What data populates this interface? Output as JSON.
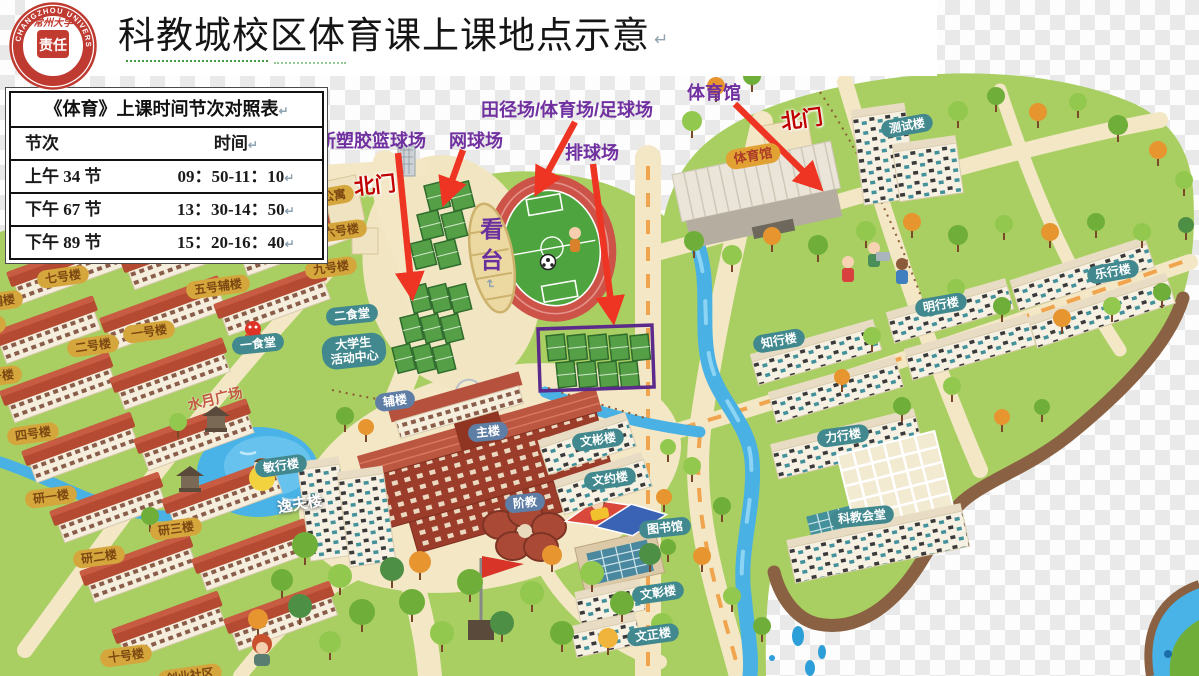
{
  "header": {
    "title": "科教城校区体育课上课地点示意",
    "return_mark": "↵",
    "logo": {
      "university_cn": "常州大学",
      "university_en": "CHANGZHOU UNIVERSITY",
      "year": "·1978·",
      "seal": "责任"
    }
  },
  "schedule_table": {
    "title": "《体育》上课时间节次对照表",
    "columns": [
      "节次",
      "时间"
    ],
    "rows": [
      {
        "period": "上午 34 节",
        "time": "09：50-11：10"
      },
      {
        "period": "下午 67 节",
        "time": "13：30-14：50"
      },
      {
        "period": "下午 89 节",
        "time": "15：20-16：40"
      }
    ]
  },
  "callouts": [
    {
      "name": "new-basketball-courts",
      "text": "新塑胶篮球场",
      "x": 318,
      "y": 127,
      "arrow": {
        "x1": 398,
        "y1": 153,
        "x2": 412,
        "y2": 294
      }
    },
    {
      "name": "tennis-courts",
      "text": "网球场",
      "x": 449,
      "y": 127,
      "arrow": {
        "x1": 463,
        "y1": 150,
        "x2": 445,
        "y2": 200
      }
    },
    {
      "name": "track-stadium-football-field",
      "text": "田径场/体育场/足球场",
      "x": 481,
      "y": 96,
      "arrow": {
        "x1": 575,
        "y1": 122,
        "x2": 538,
        "y2": 190
      }
    },
    {
      "name": "volleyball-courts",
      "text": "排球场",
      "x": 565,
      "y": 139,
      "arrow": {
        "x1": 593,
        "y1": 164,
        "x2": 613,
        "y2": 318
      }
    },
    {
      "name": "gymnasium",
      "text": "体育馆",
      "x": 687,
      "y": 79,
      "arrow": {
        "x1": 735,
        "y1": 104,
        "x2": 818,
        "y2": 186
      }
    }
  ],
  "highlight_box": {
    "x": 538,
    "y": 329,
    "w": 114,
    "h": 62,
    "color": "#5c2a8a"
  },
  "map_labels": [
    {
      "name": "north-gate-west",
      "text": "北门",
      "type": "gate",
      "x": 375,
      "y": 186,
      "r": -6
    },
    {
      "name": "north-gate-east",
      "text": "北门",
      "type": "gate",
      "x": 802,
      "y": 120,
      "r": -8
    },
    {
      "name": "apartment",
      "text": "公寓",
      "type": "olive",
      "x": 334,
      "y": 196,
      "r": -10
    },
    {
      "name": "dorm-7",
      "text": "七号楼",
      "type": "olive",
      "x": 63,
      "y": 277,
      "r": -8
    },
    {
      "name": "dorm-5-annex",
      "text": "五号辅楼",
      "type": "olive",
      "x": 218,
      "y": 287,
      "r": -8
    },
    {
      "name": "dorm-9",
      "text": "九号楼",
      "type": "olive",
      "x": 331,
      "y": 268,
      "r": -8
    },
    {
      "name": "dorm-6",
      "text": "六号楼",
      "type": "olive",
      "x": 341,
      "y": 231,
      "r": -8
    },
    {
      "name": "dorm-1",
      "text": "一号楼",
      "type": "olive",
      "x": 149,
      "y": 332,
      "r": -8
    },
    {
      "name": "dorm-2",
      "text": "二号楼",
      "type": "olive",
      "x": 93,
      "y": 346,
      "r": -8
    },
    {
      "name": "annex-partial",
      "text": "辅楼",
      "type": "olive",
      "x": 3,
      "y": 301,
      "r": -8
    },
    {
      "name": "dorm-8",
      "text": "八号楼",
      "type": "olive",
      "x": -20,
      "y": 327,
      "r": -8
    },
    {
      "name": "dorm-3",
      "text": "三号楼",
      "type": "olive",
      "x": -4,
      "y": 377,
      "r": -8
    },
    {
      "name": "dorm-4",
      "text": "四号楼",
      "type": "olive",
      "x": 33,
      "y": 434,
      "r": -8
    },
    {
      "name": "grad-building-1",
      "text": "研一楼",
      "type": "olive",
      "x": 51,
      "y": 497,
      "r": -8
    },
    {
      "name": "grad-building-3",
      "text": "研三楼",
      "type": "olive",
      "x": 176,
      "y": 529,
      "r": -8
    },
    {
      "name": "grad-building-2",
      "text": "研二楼",
      "type": "olive",
      "x": 99,
      "y": 557,
      "r": -8
    },
    {
      "name": "dorm-10",
      "text": "十号楼",
      "type": "olive",
      "x": 126,
      "y": 656,
      "r": -8
    },
    {
      "name": "startup-community",
      "text": "创业社区",
      "type": "olive",
      "x": 190,
      "y": 676,
      "r": -8
    },
    {
      "name": "canteen-1",
      "text": "一食堂",
      "type": "teal",
      "x": 258,
      "y": 344,
      "r": -6
    },
    {
      "name": "canteen-2",
      "text": "二食堂",
      "type": "teal",
      "x": 352,
      "y": 315,
      "r": -6
    },
    {
      "name": "student-activity-center",
      "text": "大学生\n活动中心",
      "type": "teal",
      "x": 354,
      "y": 351,
      "r": -6
    },
    {
      "name": "minxing-building",
      "text": "敏行楼",
      "type": "teal",
      "x": 281,
      "y": 466,
      "r": -8
    },
    {
      "name": "yifu-building",
      "text": "逸夫楼",
      "type": "white",
      "x": 300,
      "y": 505,
      "r": -10
    },
    {
      "name": "shuiyue-square",
      "text": "水月广场",
      "type": "rust",
      "x": 215,
      "y": 399,
      "r": -14
    },
    {
      "name": "auxiliary-building",
      "text": "辅楼",
      "type": "slate",
      "x": 395,
      "y": 401,
      "r": -8
    },
    {
      "name": "main-building",
      "text": "主楼",
      "type": "slate",
      "x": 488,
      "y": 432,
      "r": -6
    },
    {
      "name": "tiered-classroom",
      "text": "阶教",
      "type": "slate",
      "x": 525,
      "y": 503,
      "r": -6
    },
    {
      "name": "wenbin-building",
      "text": "文彬楼",
      "type": "teal",
      "x": 598,
      "y": 440,
      "r": -8
    },
    {
      "name": "wenyue-building",
      "text": "文约楼",
      "type": "teal",
      "x": 610,
      "y": 479,
      "r": -8
    },
    {
      "name": "library",
      "text": "图书馆",
      "type": "teal",
      "x": 665,
      "y": 528,
      "r": -6
    },
    {
      "name": "wenzhang-building",
      "text": "文彰楼",
      "type": "teal",
      "x": 658,
      "y": 593,
      "r": -8
    },
    {
      "name": "wenzheng-building",
      "text": "文正楼",
      "type": "teal",
      "x": 653,
      "y": 635,
      "r": -8
    },
    {
      "name": "gymnasium-badge",
      "text": "体育馆",
      "type": "orange",
      "x": 753,
      "y": 156,
      "r": -10
    },
    {
      "name": "test-building",
      "text": "测试楼",
      "type": "teal",
      "x": 907,
      "y": 126,
      "r": -10
    },
    {
      "name": "zhixing-building",
      "text": "知行楼",
      "type": "teal",
      "x": 779,
      "y": 341,
      "r": -10
    },
    {
      "name": "mingxing-building",
      "text": "明行楼",
      "type": "teal",
      "x": 941,
      "y": 305,
      "r": -10
    },
    {
      "name": "lexing-building",
      "text": "乐行楼",
      "type": "teal",
      "x": 1113,
      "y": 272,
      "r": -10
    },
    {
      "name": "lixing-building",
      "text": "力行楼",
      "type": "teal",
      "x": 843,
      "y": 436,
      "r": -8
    },
    {
      "name": "science-education-hall",
      "text": "科教会堂",
      "type": "teal",
      "x": 862,
      "y": 517,
      "r": -6
    },
    {
      "name": "grandstand",
      "text": "看台",
      "type": "stand",
      "x": 489,
      "y": 257,
      "r": 0
    }
  ],
  "colors": {
    "callout": "#7030a0",
    "arrow": "#ee3524",
    "land": "#a9cf62",
    "river": "#4ab1e4"
  }
}
